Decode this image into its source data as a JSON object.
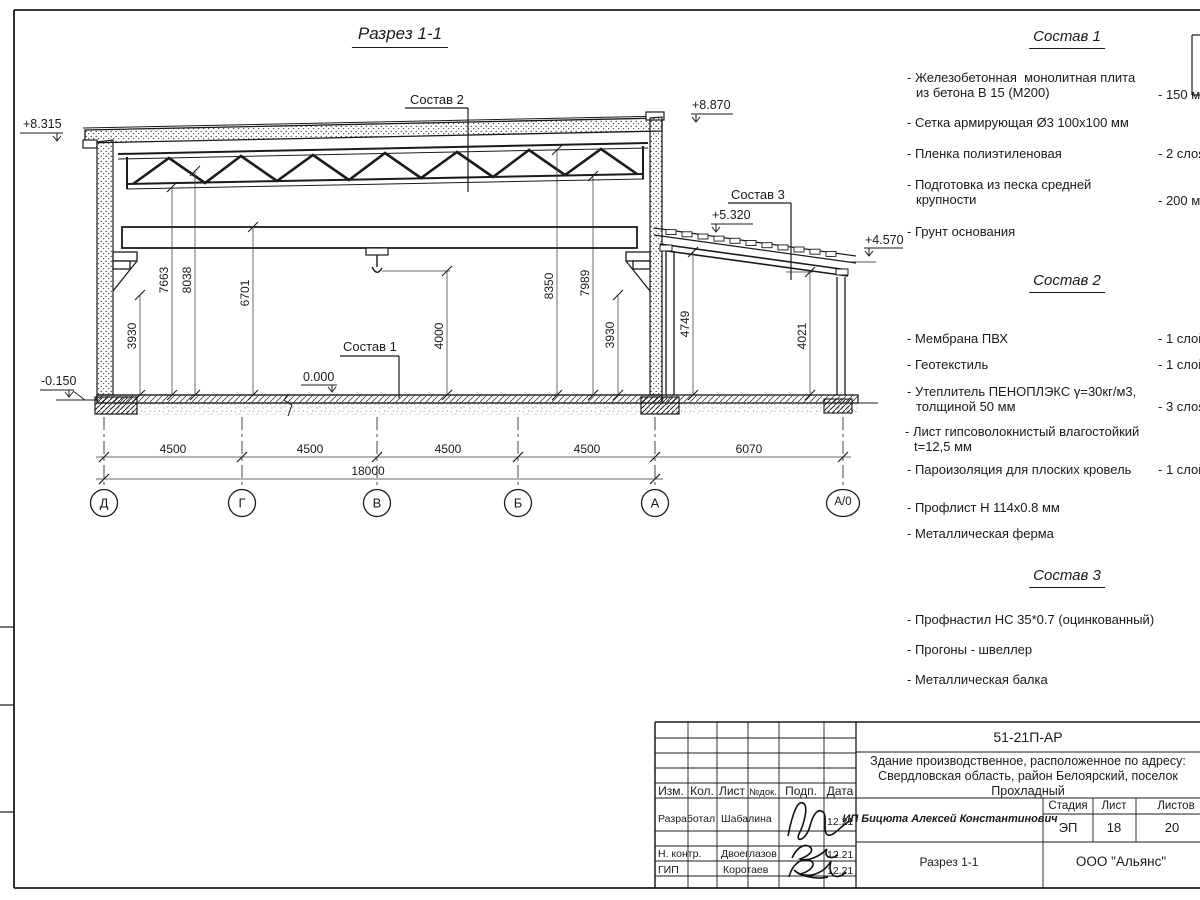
{
  "title": "Разрез 1-1",
  "callouts": {
    "c1": "Состав 1",
    "c2": "Состав 2",
    "c3": "Состав 3"
  },
  "elevations": {
    "roof_left": "+8.315",
    "roof_right": "+8.870",
    "annex_top": "+5.320",
    "annex_eave": "+4.570",
    "floor_zero": "0.000",
    "grade": "-0.150"
  },
  "dims": {
    "v_3930_left": "3930",
    "v_7663": "7663",
    "v_8038": "8038",
    "v_6701": "6701",
    "v_4000": "4000",
    "v_8350": "8350",
    "v_7989": "7989",
    "v_3930_right": "3930",
    "v_4749": "4749",
    "v_4021": "4021",
    "span1": "4500",
    "span2": "4500",
    "span3": "4500",
    "span4": "4500",
    "total": "18000",
    "annex_span": "6070"
  },
  "axes": {
    "a1": "Д",
    "a2": "Г",
    "a3": "В",
    "a4": "Б",
    "a5": "А",
    "a6": "А/0"
  },
  "compositions": [
    {
      "title": "Состав 1",
      "items": [
        {
          "text": "- Железобетонная  монолитная плита\nиз бетона В 15 (М200)",
          "value": "- 150 мм"
        },
        {
          "text": "- Сетка армирующая Ø3 100х100 мм",
          "value": ""
        },
        {
          "text": "- Пленка полиэтиленовая",
          "value": "-  2 слоя"
        },
        {
          "text": "- Подготовка из песка средней\nкрупности",
          "value": "- 200 мм"
        },
        {
          "text": "- Грунт основания",
          "value": ""
        }
      ]
    },
    {
      "title": "Состав 2",
      "items": [
        {
          "text": "- Мембрана ПВХ",
          "value": "- 1 слой"
        },
        {
          "text": "- Геотекстиль",
          "value": "- 1 слой"
        },
        {
          "text": "- Утеплитель ПЕНОПЛЭКС γ=30кг/м3,\nтолщиной 50 мм",
          "value": "- 3 слоя"
        },
        {
          "text": "- Лист гипсоволокнистый влагостойкий\nt=12,5 мм",
          "value": ""
        },
        {
          "text": "- Пароизоляция для плоских кровель",
          "value": "- 1 слой"
        },
        {
          "text": "- Профлист Н 114х0.8 мм",
          "value": ""
        },
        {
          "text": "- Металлическая ферма",
          "value": ""
        }
      ]
    },
    {
      "title": "Состав 3",
      "items": [
        {
          "text": "- Профнастил НС 35*0.7 (оцинкованный)",
          "value": ""
        },
        {
          "text": "- Прогоны - швеллер",
          "value": ""
        },
        {
          "text": "- Металлическая балка",
          "value": ""
        }
      ]
    }
  ],
  "title_block": {
    "doc_number": "51-21П-АР",
    "project_line1": "Здание производственное, расположенное по адресу:",
    "project_line2": "Свердловская область, район Белоярский, поселок",
    "project_line3": "Прохладный",
    "col_izm": "Изм.",
    "col_kol": "Кол.",
    "col_list": "Лист",
    "col_ndok": "№док.",
    "col_podp": "Подп.",
    "col_data": "Дата",
    "row1_role": "Разработал",
    "row1_name": "Шабалина",
    "row1_date": "12.21",
    "row2_role": "Н. контр.",
    "row2_name": "Двоеглазов",
    "row2_date": "12.21",
    "row3_role": "ГИП",
    "row3_name": "Коротаев",
    "row3_date": "12.21",
    "client": "ИП Бицюта Алексей Константинович",
    "stage_label": "Стадия",
    "sheet_label": "Лист",
    "sheets_label": "Листов",
    "stage": "ЭП",
    "sheet": "18",
    "sheets": "20",
    "view_name": "Разрез 1-1",
    "company": "ООО \"Альянс\""
  }
}
